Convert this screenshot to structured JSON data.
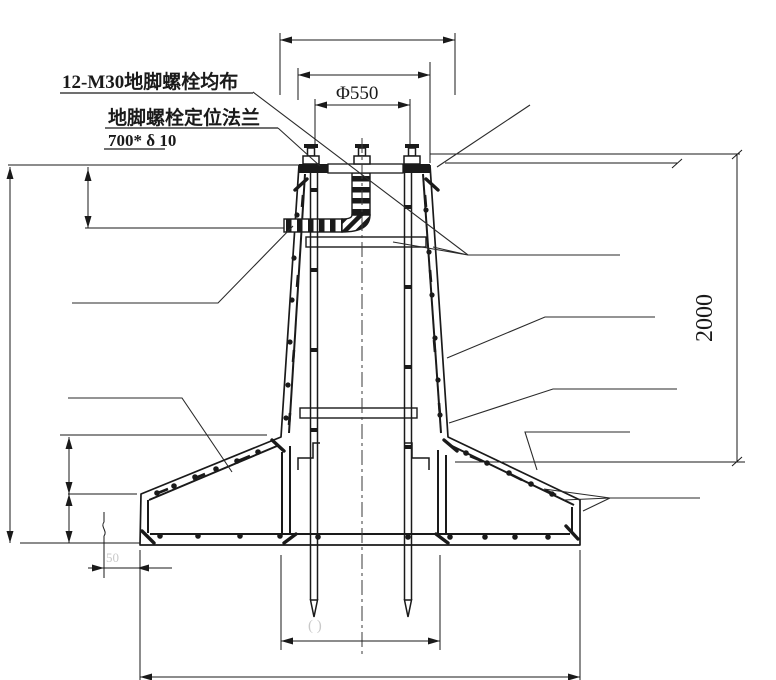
{
  "drawing": {
    "labels": {
      "anchor_bolts": "12-M30地脚螺栓均布",
      "flange": "地脚螺栓定位法兰",
      "flange_size": "700* δ 10"
    },
    "dimensions": {
      "bolt_circle": "Φ550",
      "depth": "2000",
      "edge_offset": "50",
      "hidden_dim": "(    )"
    },
    "colors": {
      "line": "#1a1a1a",
      "background": "#ffffff",
      "faint_mark": "#c9c9c9"
    }
  }
}
